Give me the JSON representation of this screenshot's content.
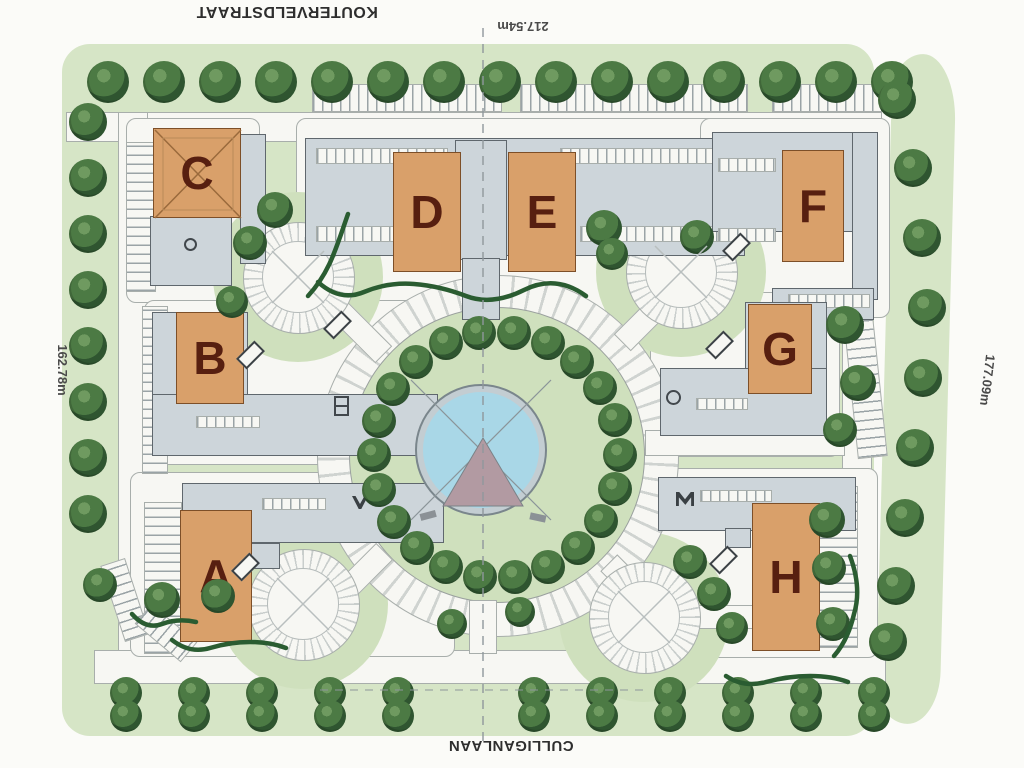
{
  "labels": {
    "street_top": "KOUTERVELDSTRAAT",
    "street_bottom": "CULLIGANLAAN",
    "dim_top": "217.54m",
    "dim_left": "162.78m",
    "dim_right": "177.09m"
  },
  "buildings": [
    {
      "label": "A"
    },
    {
      "label": "B"
    },
    {
      "label": "C"
    },
    {
      "label": "D"
    },
    {
      "label": "E"
    },
    {
      "label": "F"
    },
    {
      "label": "G"
    },
    {
      "label": "H"
    }
  ],
  "colors": {
    "page": "#fbfbf8",
    "grass": "#d6e5c6",
    "grass2": "#cfe0bd",
    "road": "#f7f7f3",
    "roadline": "#a8aeab",
    "slab": "#cdd5da",
    "slabline": "#5f676d",
    "orange": "#d9a06a",
    "orangeline": "#7d4f28",
    "letter": "#571f10",
    "tree": "#4c7a44",
    "treedark": "#2f5530",
    "treelight": "#6f9a60",
    "pond": "#a9d7e7",
    "pondrim": "#c3cdd2",
    "pyramid": "#b29aa2",
    "hedge": "#2a5c31",
    "tick": "#9aa3a6",
    "dash": "#8f979c"
  }
}
